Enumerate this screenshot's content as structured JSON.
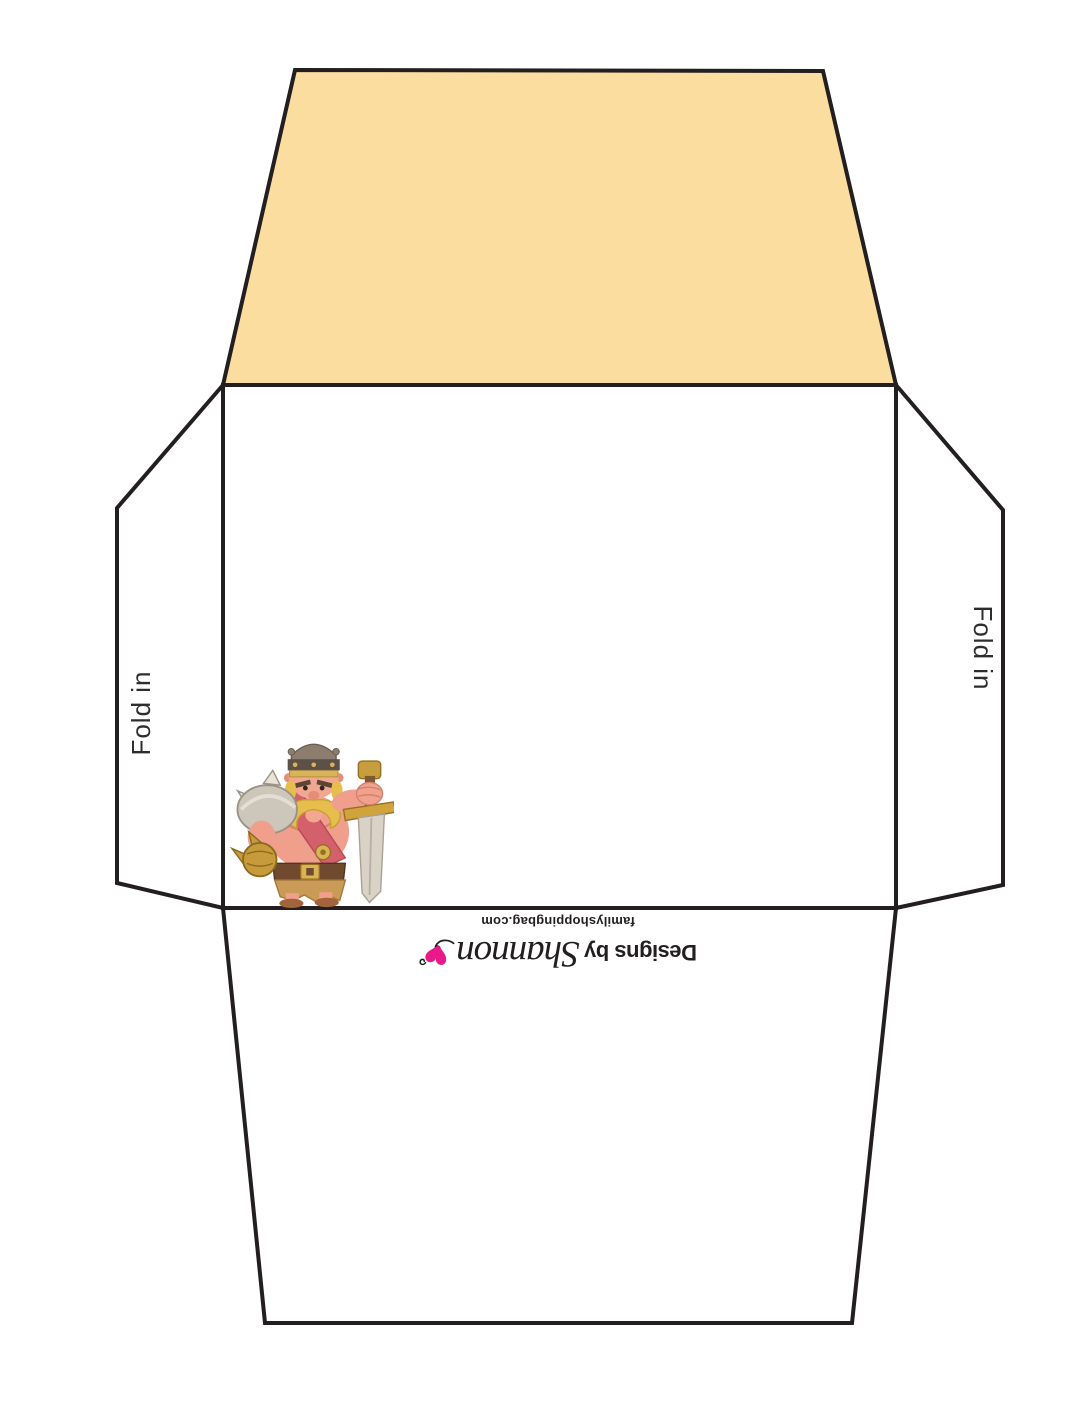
{
  "page": {
    "width": 1088,
    "height": 1408,
    "background": "#ffffff"
  },
  "colors": {
    "outline": "#231f20",
    "top_flap_fill": "#fcdda0",
    "body_fill": "#ffffff",
    "logo_pink": "#e9198c",
    "label_text": "#2e2c2d"
  },
  "flaps": {
    "left": {
      "label": "Fold in"
    },
    "right": {
      "label": "Fold in"
    }
  },
  "branding": {
    "designs_by": "Designs by",
    "name": "Shannon",
    "website": "familyshoppingbag.com",
    "heart_icon": "heart-swirl-icon"
  },
  "artwork": {
    "character": "Barbarian King"
  }
}
